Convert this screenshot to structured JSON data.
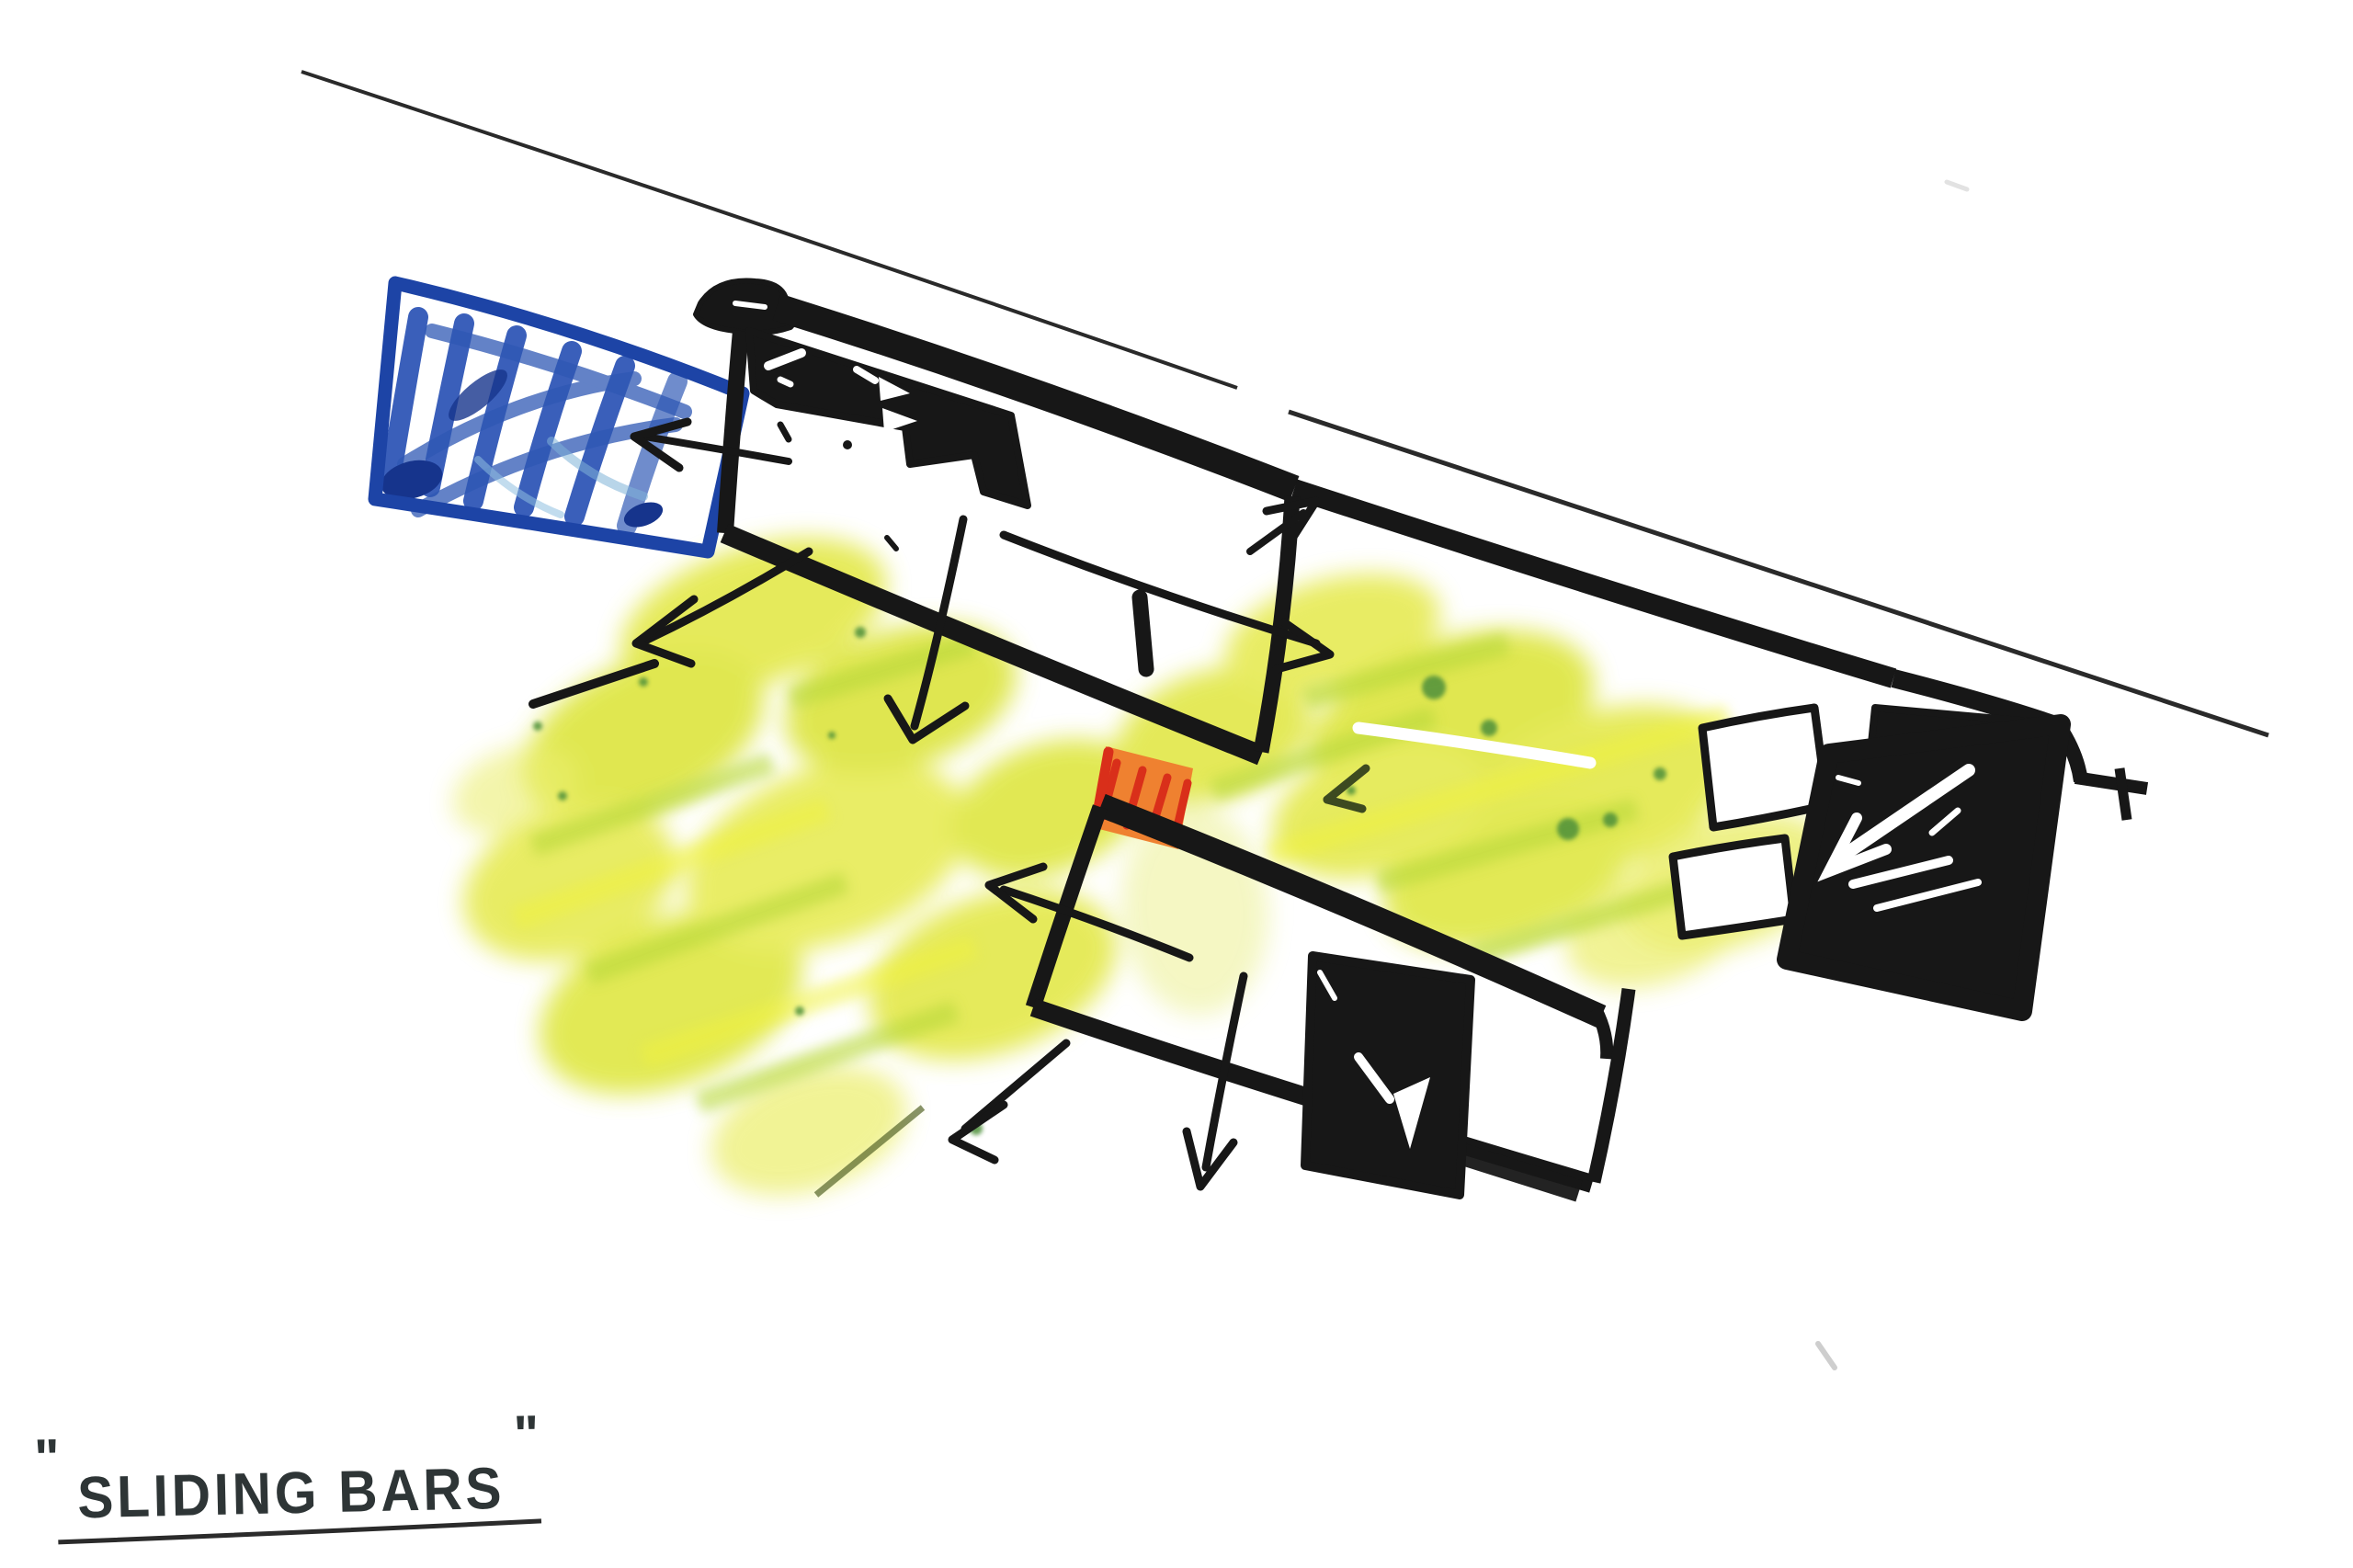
{
  "page": {
    "kind": "hand-drawn architectural concept sketch (marker and crayon on white paper)",
    "background": "#ffffff"
  },
  "caption": {
    "open_quote": "\"",
    "text": "SLIDING BARS",
    "close_quote": "\"",
    "underlined": true
  },
  "colors": {
    "paper": "#ffffff",
    "ink": "#171717",
    "caption_ink": "#2e3536",
    "marker_blue": "#1d44a6",
    "marker_blue_fill": "#2a52b5",
    "marker_blue_dark": "#16348c",
    "crayon_yellow": "#e3e84a",
    "crayon_green": "#b7d83a",
    "crayon_green_dark": "#4e8f3a",
    "accent_orange": "#ef8130",
    "accent_red": "#d92f1a",
    "white_out": "#ffffff",
    "faint_gray": "#bdbdbd"
  },
  "legend": {
    "site_line": "thin diagonal site/boundary line across top",
    "blue_panel": "blue scribbled rectangle at upper left",
    "upper_bar": "upper sliding bar volume with solid black block and direction arrows",
    "lower_bar": "lower sliding bar volume with solid black block and direction arrows",
    "connector_joint": "orange hatched joint between the two bars",
    "right_black_panel": "solid black panel with white arrow marks at right",
    "small_rooms": "two small outlined rectangles beside black panel",
    "landscape_shading": "yellow-green crayon landscape shading",
    "white_highlight_arrow": "white gel highlight line with small dark arrowhead over shading"
  }
}
